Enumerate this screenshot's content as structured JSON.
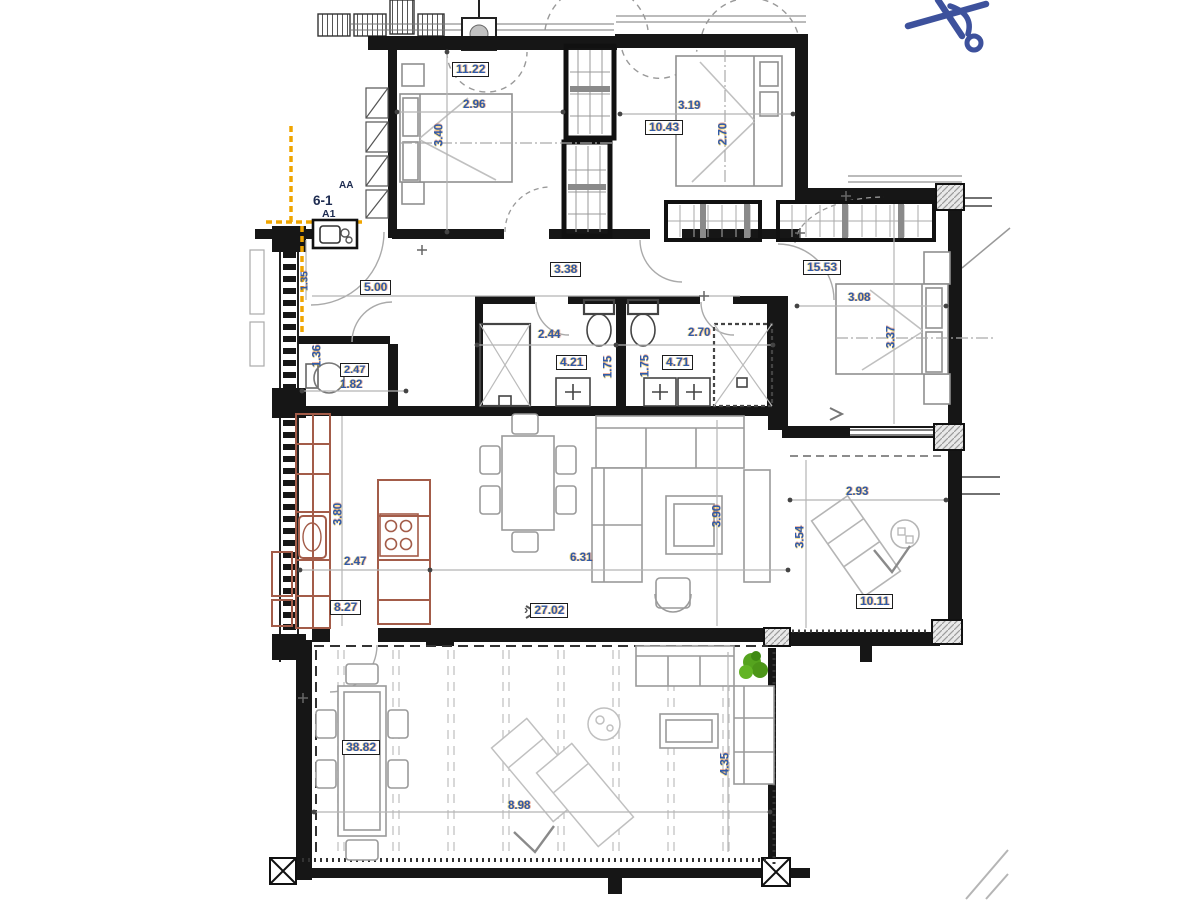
{
  "markers": {
    "unit": "6-1",
    "entrance": "A1",
    "section": "AA",
    "arrow_glyph": "›"
  },
  "rooms": [
    {
      "id": "bedroom-1",
      "area": "11.22",
      "width": "2.96",
      "depth": "3.40"
    },
    {
      "id": "bedroom-2",
      "area": "10.43",
      "width": "3.19",
      "depth": "2.70"
    },
    {
      "id": "master-bedroom",
      "area": "15.53",
      "width": "3.08",
      "depth": "3.37"
    },
    {
      "id": "hallway",
      "area": "5.00",
      "length": "3.38",
      "entry_width": "1.35"
    },
    {
      "id": "wc",
      "area": "2.47",
      "width": "1.82",
      "depth": "1.36"
    },
    {
      "id": "bathroom-1",
      "area": "4.21",
      "width": "2.44",
      "depth": "1.75"
    },
    {
      "id": "bathroom-2",
      "area": "4.71",
      "width": "2.70",
      "depth": "1.75"
    },
    {
      "id": "kitchen",
      "area": "8.27",
      "width": "2.47",
      "depth": "3.80"
    },
    {
      "id": "living-dining",
      "area": "27.02",
      "width": "6.31",
      "depth": "3.90"
    },
    {
      "id": "covered-terrace",
      "area": "10.11",
      "width": "2.93",
      "depth": "3.54"
    },
    {
      "id": "terrace",
      "area": "38.82",
      "width": "8.98",
      "depth": "4.35"
    }
  ],
  "colors": {
    "wall": "#161616",
    "dimension_text": "#2f5aa8",
    "kitchen": "#a35c49",
    "boundary": "#f0a500",
    "north_arrow": "#3d519c",
    "plant": "#55a31e"
  }
}
